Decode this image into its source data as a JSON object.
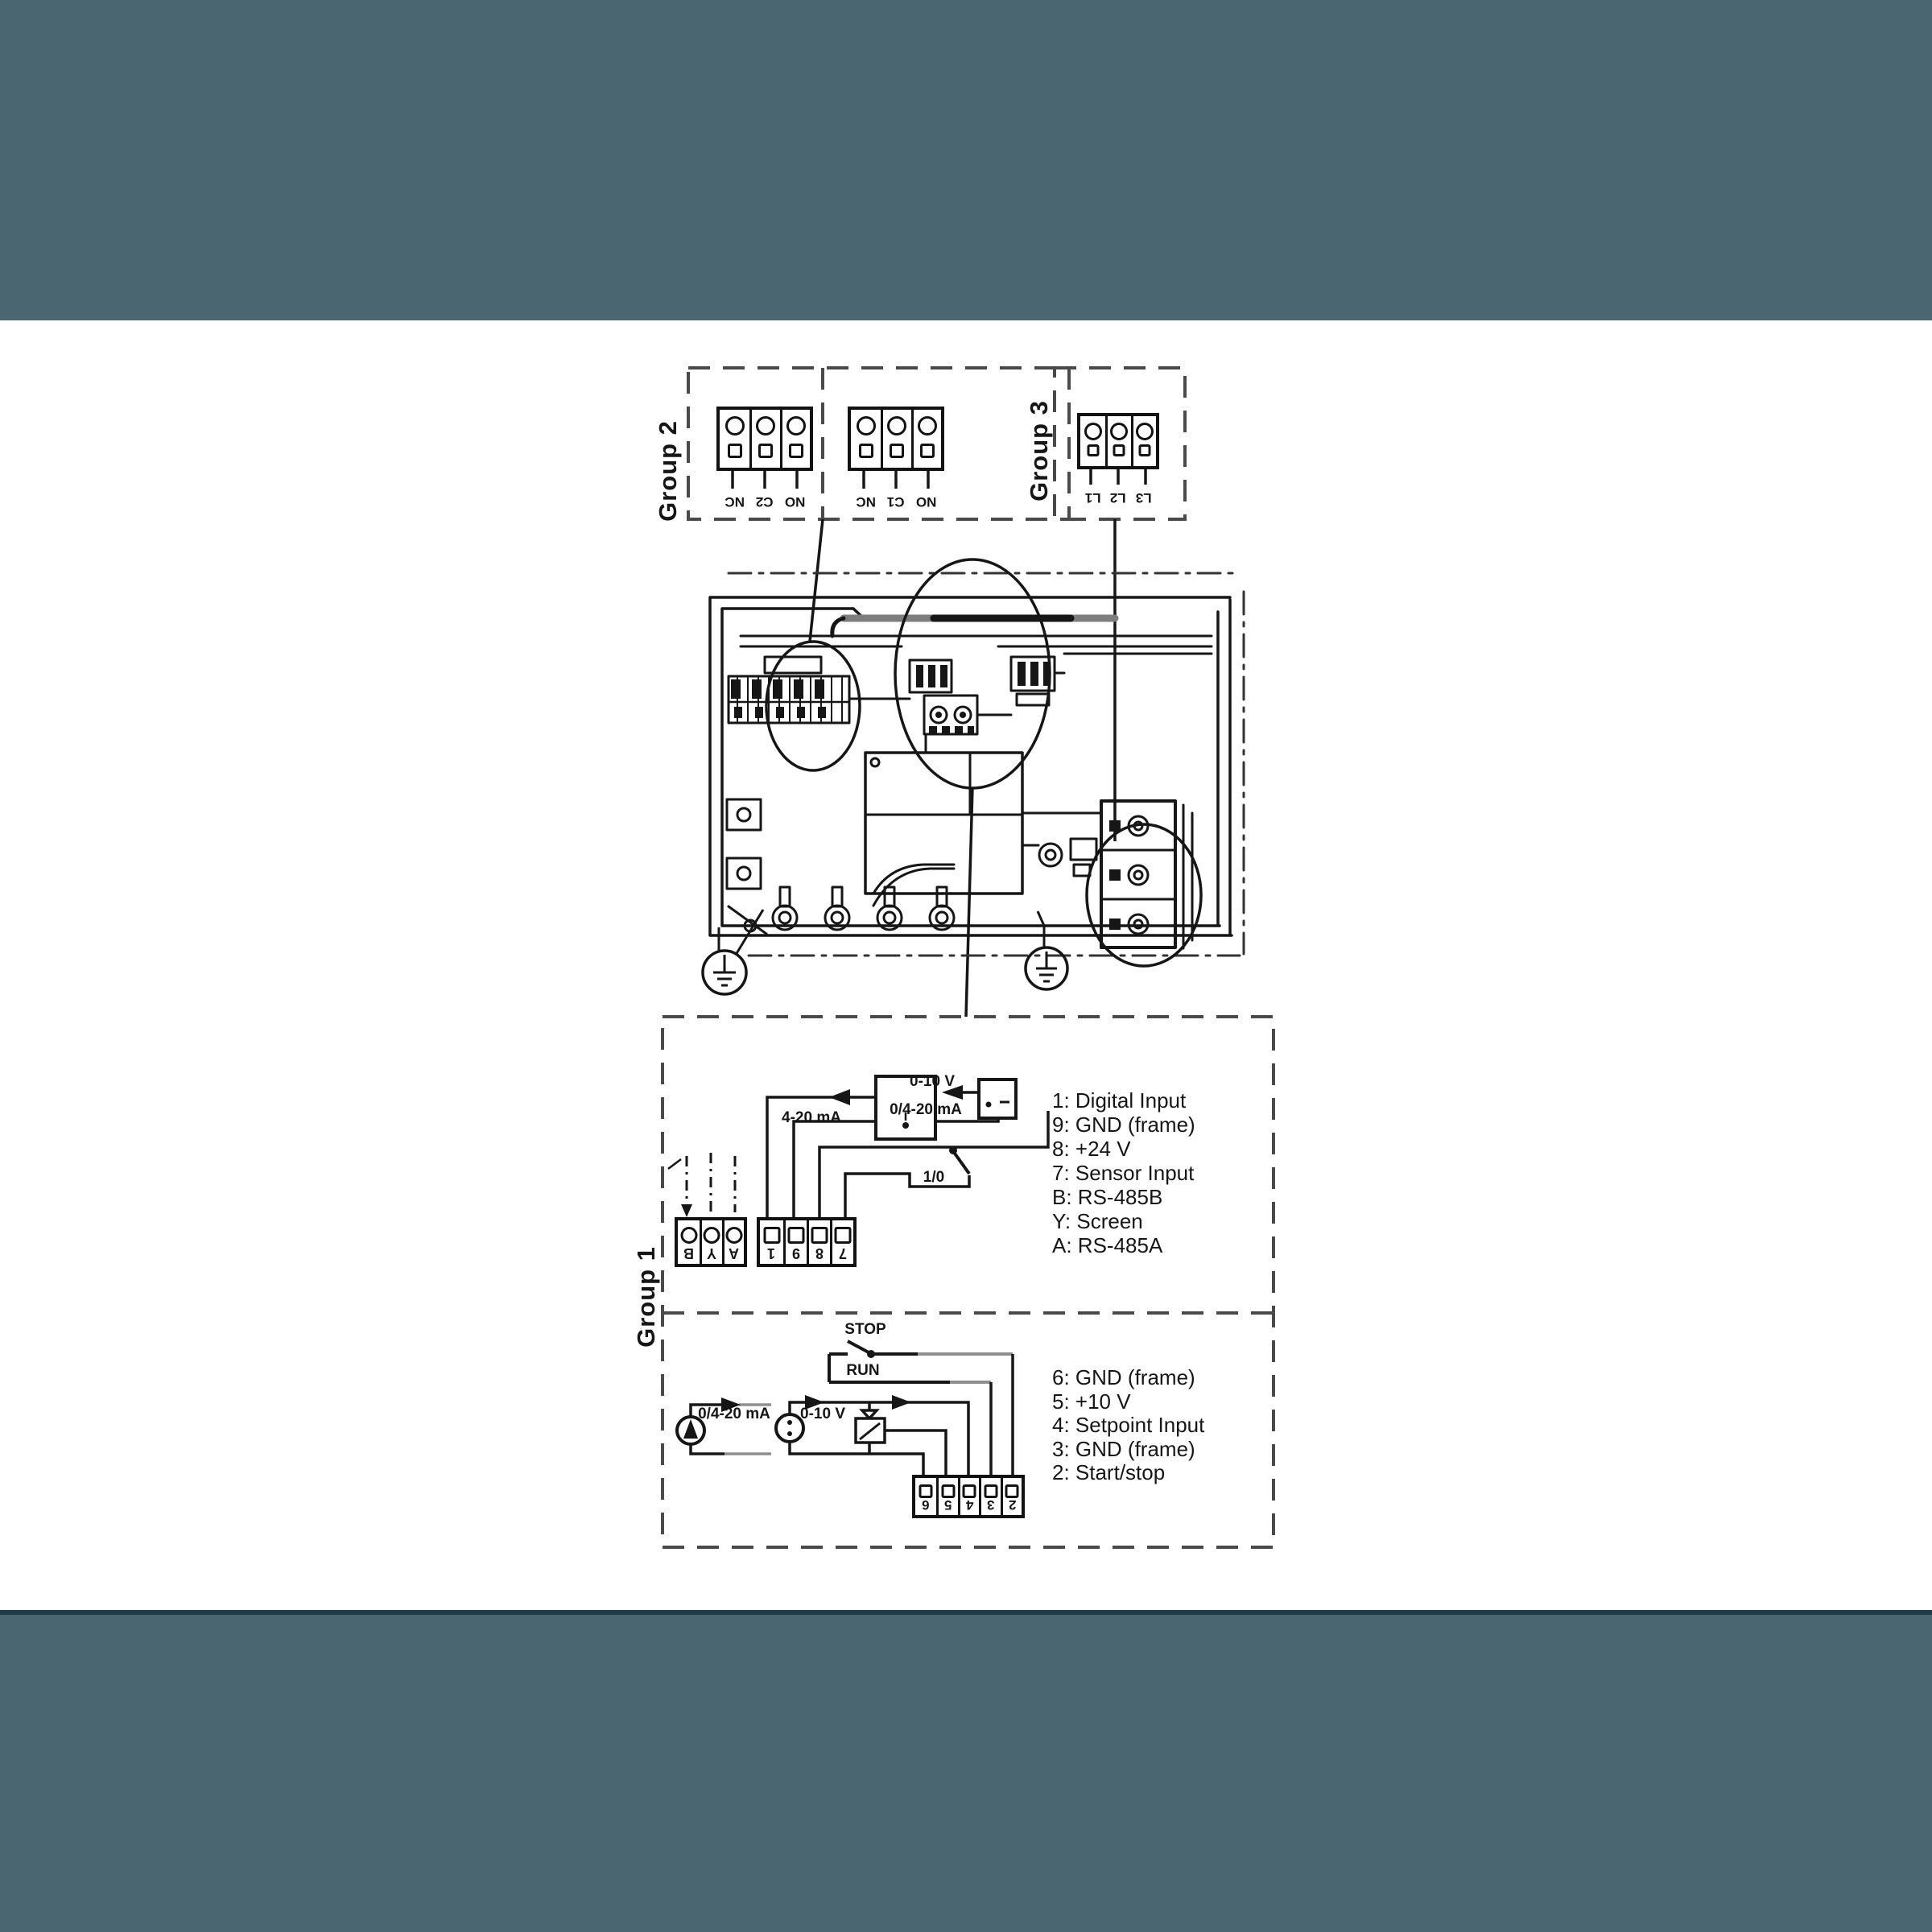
{
  "page": {
    "band_color": "#4A6670",
    "band_edge_color": "#203C49",
    "line_color": "#161616",
    "dash_color": "#4a4a4a",
    "gray_wire_color": "#8f8f8f"
  },
  "groups": {
    "group2": {
      "label": "Group 2",
      "blocks": [
        {
          "terminals": [
            "NC",
            "C2",
            "NO"
          ]
        },
        {
          "terminals": [
            "NC",
            "C1",
            "NO"
          ]
        }
      ]
    },
    "group3": {
      "label": "Group 3",
      "blocks": [
        {
          "terminals": [
            "L1",
            "L2",
            "L3"
          ]
        }
      ]
    },
    "group1": {
      "label": "Group 1",
      "upper": {
        "terminal_block_left": [
          "B",
          "Y",
          "A"
        ],
        "terminal_block_right": [
          "1",
          "9",
          "8",
          "7"
        ],
        "labels": {
          "current_range": "4-20 mA",
          "voltage_range": "0-10 V",
          "combined_range": "0/4-20 mA",
          "switch": "1/0"
        },
        "legend": [
          {
            "key": "1",
            "desc": "Digital Input"
          },
          {
            "key": "9",
            "desc": "GND (frame)"
          },
          {
            "key": "8",
            "desc": "+24 V"
          },
          {
            "key": "7",
            "desc": "Sensor Input"
          },
          {
            "key": "B",
            "desc": "RS-485B"
          },
          {
            "key": "Y",
            "desc": "Screen"
          },
          {
            "key": "A",
            "desc": "RS-485A"
          }
        ]
      },
      "lower": {
        "terminal_block": [
          "6",
          "5",
          "4",
          "3",
          "2"
        ],
        "labels": {
          "switch_open": "STOP",
          "switch_closed": "RUN",
          "current_range": "0/4-20 mA",
          "voltage_range": "0-10 V"
        },
        "legend": [
          {
            "key": "6",
            "desc": "GND (frame)"
          },
          {
            "key": "5",
            "desc": "+10 V"
          },
          {
            "key": "4",
            "desc": "Setpoint Input"
          },
          {
            "key": "3",
            "desc": "GND (frame)"
          },
          {
            "key": "2",
            "desc": "Start/stop"
          }
        ]
      }
    }
  }
}
